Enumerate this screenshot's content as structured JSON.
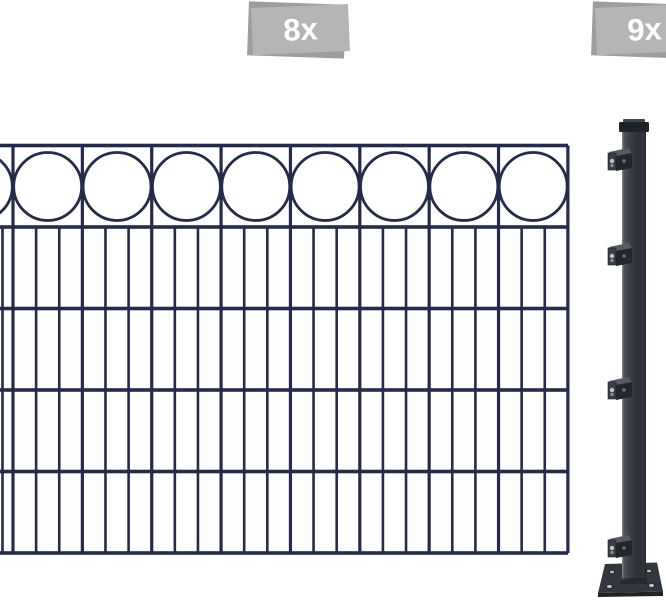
{
  "image": {
    "width": 666,
    "height": 600,
    "background": "#ffffff"
  },
  "badges": [
    {
      "id": "panel-count",
      "label": "8x",
      "x": 246,
      "y": 2,
      "width": 104,
      "height": 58
    },
    {
      "id": "post-count",
      "label": "9x",
      "x": 590,
      "y": 2,
      "width": 104,
      "height": 58
    }
  ],
  "colors": {
    "fence": "#252b48",
    "badge_front": "#b5b5b5",
    "badge_back": "#9e9e9e",
    "badge_text": "#ffffff",
    "cap": "#1e2126",
    "cap_bevel": "#42474d",
    "post_edge_dark": "#24282d",
    "post_edge_light": "#7b8187",
    "bracket_top": "#575c62",
    "bracket_plate": "#3a3f45",
    "bracket_body": "#23262b",
    "bracket_back": "#2c3036",
    "screw_light": "#c0c4c8",
    "screw_mid": "#8e9298",
    "screw_dark": "#6d7278",
    "plate_top": "#33373d",
    "plate_edge": "#1f2226",
    "hole_fill": "#b9bdc1",
    "hole_rim": "#16181b",
    "post_gradient": [
      [
        "0%",
        "#5d6369"
      ],
      [
        "18%",
        "#454a50"
      ],
      [
        "50%",
        "#30353b"
      ],
      [
        "78%",
        "#2a2f35"
      ],
      [
        "100%",
        "#3a3f45"
      ]
    ]
  },
  "fence": {
    "left": 0,
    "right": 568,
    "rail_ys": [
      145.5,
      227,
      308.5,
      390,
      471.5,
      553
    ],
    "divider_start_x": 13,
    "cell_width": 69.36,
    "cell_count": 8,
    "extra_left_bar_x": 2.5,
    "circle_count": 9,
    "circle_cy": 186.5,
    "circle_r": 34,
    "rail_w": 3.6,
    "divider_w": 3.2,
    "bar_w": 2.6,
    "circle_stroke": 2.8
  },
  "post": {
    "x": 622,
    "width": 24,
    "top": 130,
    "bottom": 580,
    "cap": {
      "x": 619,
      "y": 119,
      "width": 30,
      "height": 13,
      "bevel_h": 4
    },
    "bracket_tops": [
      148,
      243,
      377,
      535
    ],
    "base_plate": {
      "top_left": [
        605,
        564
      ],
      "top_right": [
        657,
        562.5
      ],
      "bottom_right": [
        663,
        591.5
      ],
      "bottom_left": [
        598,
        593
      ],
      "front_bottom_y": 597,
      "holes": [
        {
          "cx": 612,
          "cy": 572,
          "rx": 2.5,
          "ry": 1.8
        },
        {
          "cx": 649,
          "cy": 571,
          "rx": 2.5,
          "ry": 1.8
        },
        {
          "cx": 609.5,
          "cy": 586.5,
          "rx": 3.0,
          "ry": 2.2
        },
        {
          "cx": 651.5,
          "cy": 585.5,
          "rx": 3.0,
          "ry": 2.2
        }
      ]
    }
  }
}
